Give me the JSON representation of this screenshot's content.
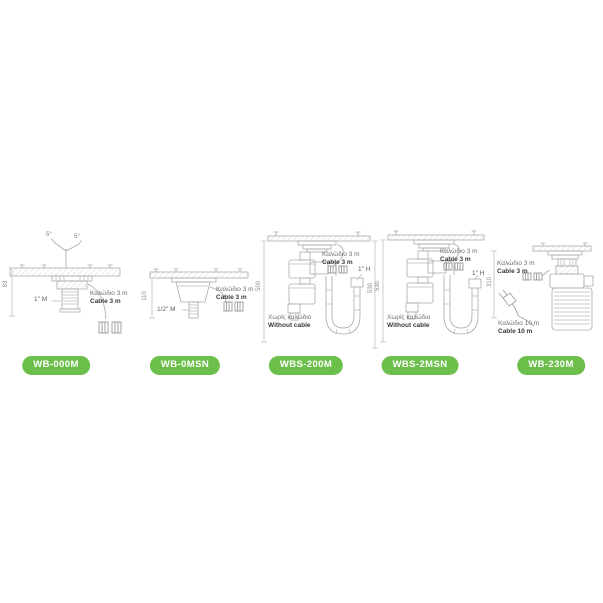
{
  "badge_color": "#6cbf4b",
  "products": [
    {
      "badge": "WB-000M",
      "angle_left": "5°",
      "angle_right": "5°",
      "dim_left": "83",
      "thread": "1\" M",
      "cable_gr": "Καλώδιο 3 m",
      "cable_en": "Cable 3 m"
    },
    {
      "badge": "WB-0MSN",
      "dim_left": "110",
      "thread": "1/2\" M",
      "cable_gr": "Καλώδιο 3 m",
      "cable_en": "Cable 3 m"
    },
    {
      "badge": "WBS-200M",
      "dim_left": "500",
      "dim_right": "530",
      "thread": "1\" H",
      "cable_gr": "Καλώδιο 3 m",
      "cable_en": "Cable 3 m",
      "nocable_gr": "Χωρίς καλώδιο",
      "nocable_en": "Without cable"
    },
    {
      "badge": "WBS-2MSN",
      "dim_left": "530",
      "thread": "1\" H",
      "cable_gr": "Καλώδιο 3 m",
      "cable_en": "Cable 3 m",
      "nocable_gr": "Χωρίς καλώδιο",
      "nocable_en": "Without cable"
    },
    {
      "badge": "WB-230M",
      "dim_left": "310",
      "cable_gr": "Καλώδιο 3 m",
      "cable_en": "Cable 3 m",
      "cable10_gr": "Καλώδιο 10 m",
      "cable10_en": "Cable 10 m"
    }
  ]
}
